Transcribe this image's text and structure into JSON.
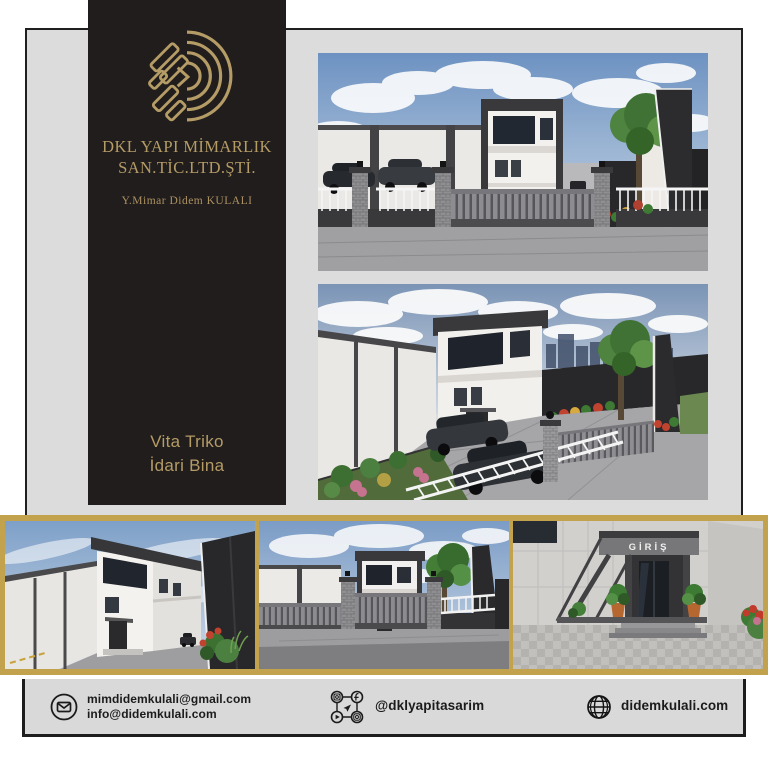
{
  "brand": {
    "company_line1": "DKL YAPI MİMARLIK",
    "company_line2": "SAN.TİC.LTD.ŞTİ.",
    "architect": "Y.Mimar Didem KULALI",
    "project_line1": "Vita Triko",
    "project_line2": "İdari Bina"
  },
  "renders": {
    "entrance_sign": "GİRİŞ"
  },
  "footer": {
    "email_line1": "mimdidemkulali@gmail.com",
    "email_line2": "info@didemkulali.com",
    "social_handle": "@dklyapitasarim",
    "website": "didemkulali.com"
  },
  "icons": {
    "email": "envelope-icon",
    "social": "social-network-icon",
    "website": "globe-icon"
  },
  "colors": {
    "gold_text": "#b59c66",
    "gold_frame": "#c3a24e",
    "panel_dark": "#201d1c",
    "card_gray": "#dcdcdd",
    "footer_gray": "#d9d9da",
    "border_dark": "#1d1d1d"
  }
}
